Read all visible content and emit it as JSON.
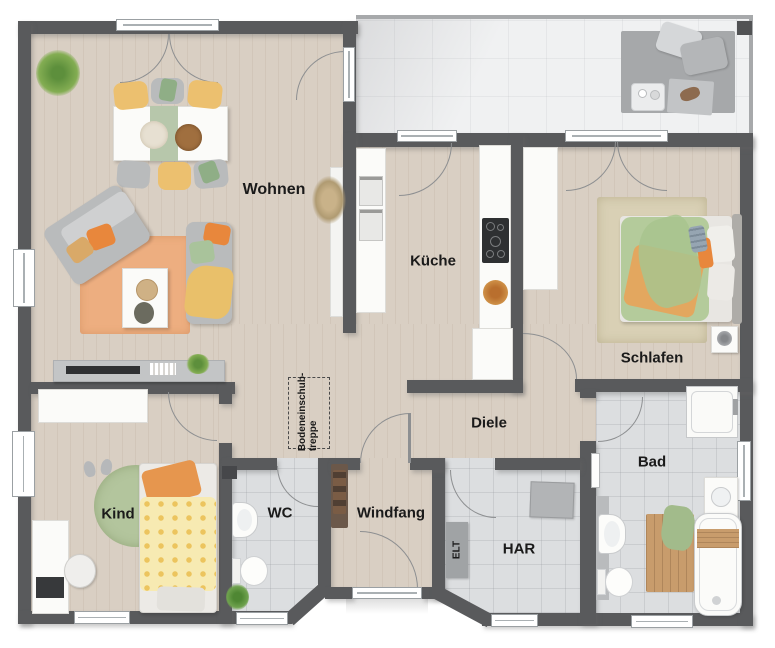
{
  "plan": {
    "rooms": {
      "wohnen": {
        "label": "Wohnen"
      },
      "kueche": {
        "label": "Küche"
      },
      "schlafen": {
        "label": "Schlafen"
      },
      "diele": {
        "label": "Diele"
      },
      "kind": {
        "label": "Kind"
      },
      "wc": {
        "label": "WC"
      },
      "windfang": {
        "label": "Windfang"
      },
      "elt": {
        "label": "ELT"
      },
      "har": {
        "label": "HAR"
      },
      "bad": {
        "label": "Bad"
      }
    },
    "annotations": {
      "attic_stairs_line1": "Bodeneinschub-",
      "attic_stairs_line2": "treppe"
    }
  },
  "theme": {
    "wall": "#595a5c",
    "wood": "#d9cfc3",
    "tile": "#dcdee0",
    "terrace": "#f0f1f2",
    "terrace-edge": "#a7a9ab",
    "arc": "#8d8f91",
    "window-frame": "#9ba0a3",
    "label": "#1a1a1a",
    "accent-orange": "#e8873c",
    "accent-yellow": "#ecc06f",
    "accent-green": "#a9c39b",
    "rug-orange": "#edae80",
    "rug-green": "#b3c59d",
    "wood-furniture": "#c89c6c"
  }
}
